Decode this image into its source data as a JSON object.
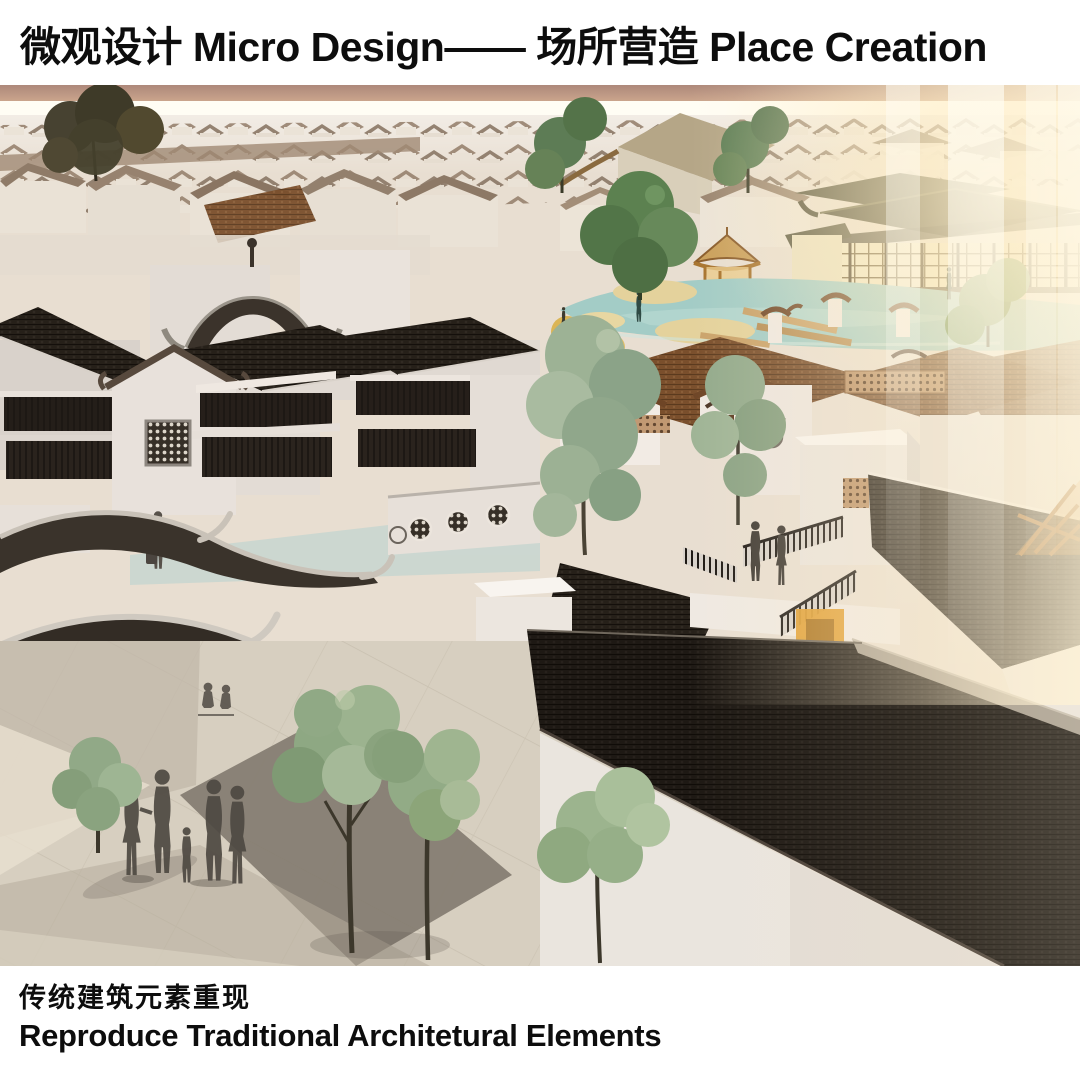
{
  "header": {
    "title": "微观设计 Micro Design—— 场所营造 Place Creation"
  },
  "footer": {
    "caption_cn": "传统建筑元素重现",
    "caption_en": "Reproduce Traditional Architetural Elements"
  },
  "render": {
    "description_labels": {
      "scene": "aerial render of traditional Chinese village streetscape",
      "elements": [
        "sunset-sky",
        "distant-village",
        "pagoda-pavilion",
        "timber-hall",
        "pond",
        "gazebo",
        "courtyard-houses",
        "lattice-windows",
        "curved-temple-roof",
        "terrace-figures",
        "giant-tile-roof",
        "plaza",
        "family-silhouettes",
        "trees",
        "light-streaks"
      ]
    },
    "palette": {
      "sky_top": "#ad887a",
      "horizon": "#fffdf4",
      "ground": "#e8ded1",
      "wall_white": "#e8e1db",
      "roof_dark": "#262019",
      "roof_brown": "#7a4f2c",
      "roof_olive": "#4e4b35",
      "pond_teal": "#a3ccc6",
      "sand": "#e4d29c",
      "glow_warm": "#ffeecd",
      "tree_green": "#8ea883",
      "silhouette": "#4e4942",
      "plaza": "#d7cfc0",
      "accent_yellow": "#df9d2f"
    }
  }
}
